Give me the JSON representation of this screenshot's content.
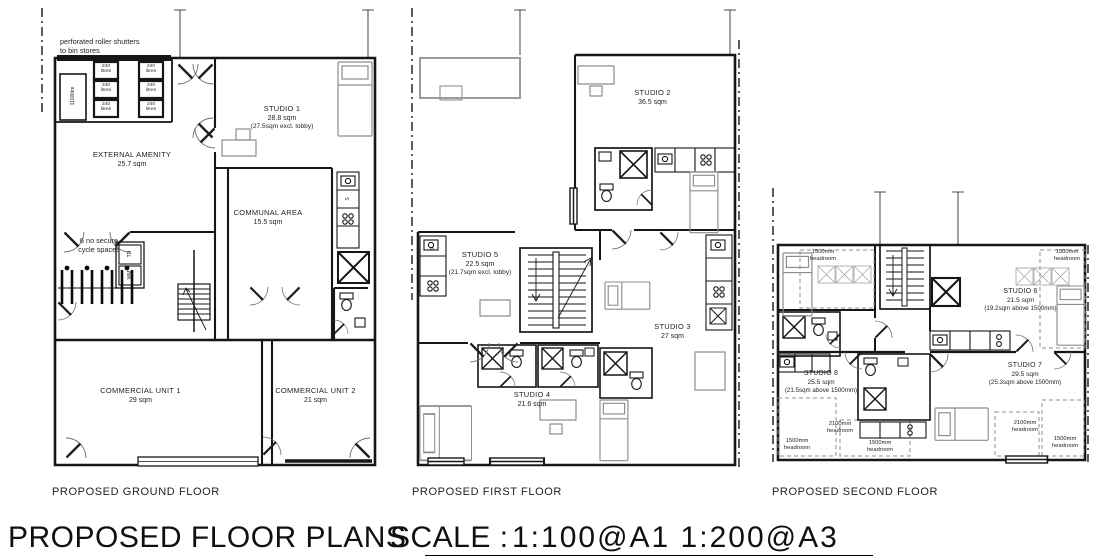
{
  "title": {
    "main": "PROPOSED FLOOR PLANS",
    "scale_label": "SCALE :",
    "scale_value": "1:100@A1  1:200@A3"
  },
  "ground": {
    "caption": "PROPOSED GROUND FLOOR",
    "bin_note": "perforated roller shutters\nto bin stores",
    "bin_large_label": "1100litre",
    "bin_small_label": "240\nlitres",
    "cycle_note": "6 no secure\ncycle spaces",
    "appliances": {
      "td": "TD",
      "wm": "WM",
      "sink": "S"
    },
    "rooms": {
      "external_amenity": {
        "name": "EXTERNAL AMENITY",
        "area": "25.7 sqm"
      },
      "studio1": {
        "name": "STUDIO 1",
        "area": "28.8 sqm",
        "note": "(27.5sqm excl. lobby)"
      },
      "communal": {
        "name": "COMMUNAL AREA",
        "area": "15.5 sqm"
      },
      "commercial1": {
        "name": "COMMERCIAL UNIT 1",
        "area": "29 sqm"
      },
      "commercial2": {
        "name": "COMMERCIAL UNIT 2",
        "area": "21 sqm"
      }
    }
  },
  "first": {
    "caption": "PROPOSED FIRST FLOOR",
    "appliances": {
      "sink": "S"
    },
    "rooms": {
      "studio2": {
        "name": "STUDIO 2",
        "area": "36.5 sqm"
      },
      "studio3": {
        "name": "STUDIO 3",
        "area": "27 sqm"
      },
      "studio4": {
        "name": "STUDIO 4",
        "area": "21.6 sqm"
      },
      "studio5": {
        "name": "STUDIO 5",
        "area": "22.5 sqm",
        "note": "(21.7sqm excl. lobby)"
      }
    }
  },
  "second": {
    "caption": "PROPOSED SECOND FLOOR",
    "headroom_1500": "1500mm\nheadroom",
    "headroom_2100": "2100mm\nheadroom",
    "rooms": {
      "studio6": {
        "name": "STUDIO 6",
        "area": "21.5 sqm",
        "note": "(19.2sqm above 1500mm)"
      },
      "studio7": {
        "name": "STUDIO 7",
        "area": "29.5 sqm",
        "note": "(25.3sqm above 1500mm)"
      },
      "studio8": {
        "name": "STUDIO 8",
        "area": "25.5 sqm",
        "note": "(21.5sqm above 1500mm)"
      }
    }
  }
}
